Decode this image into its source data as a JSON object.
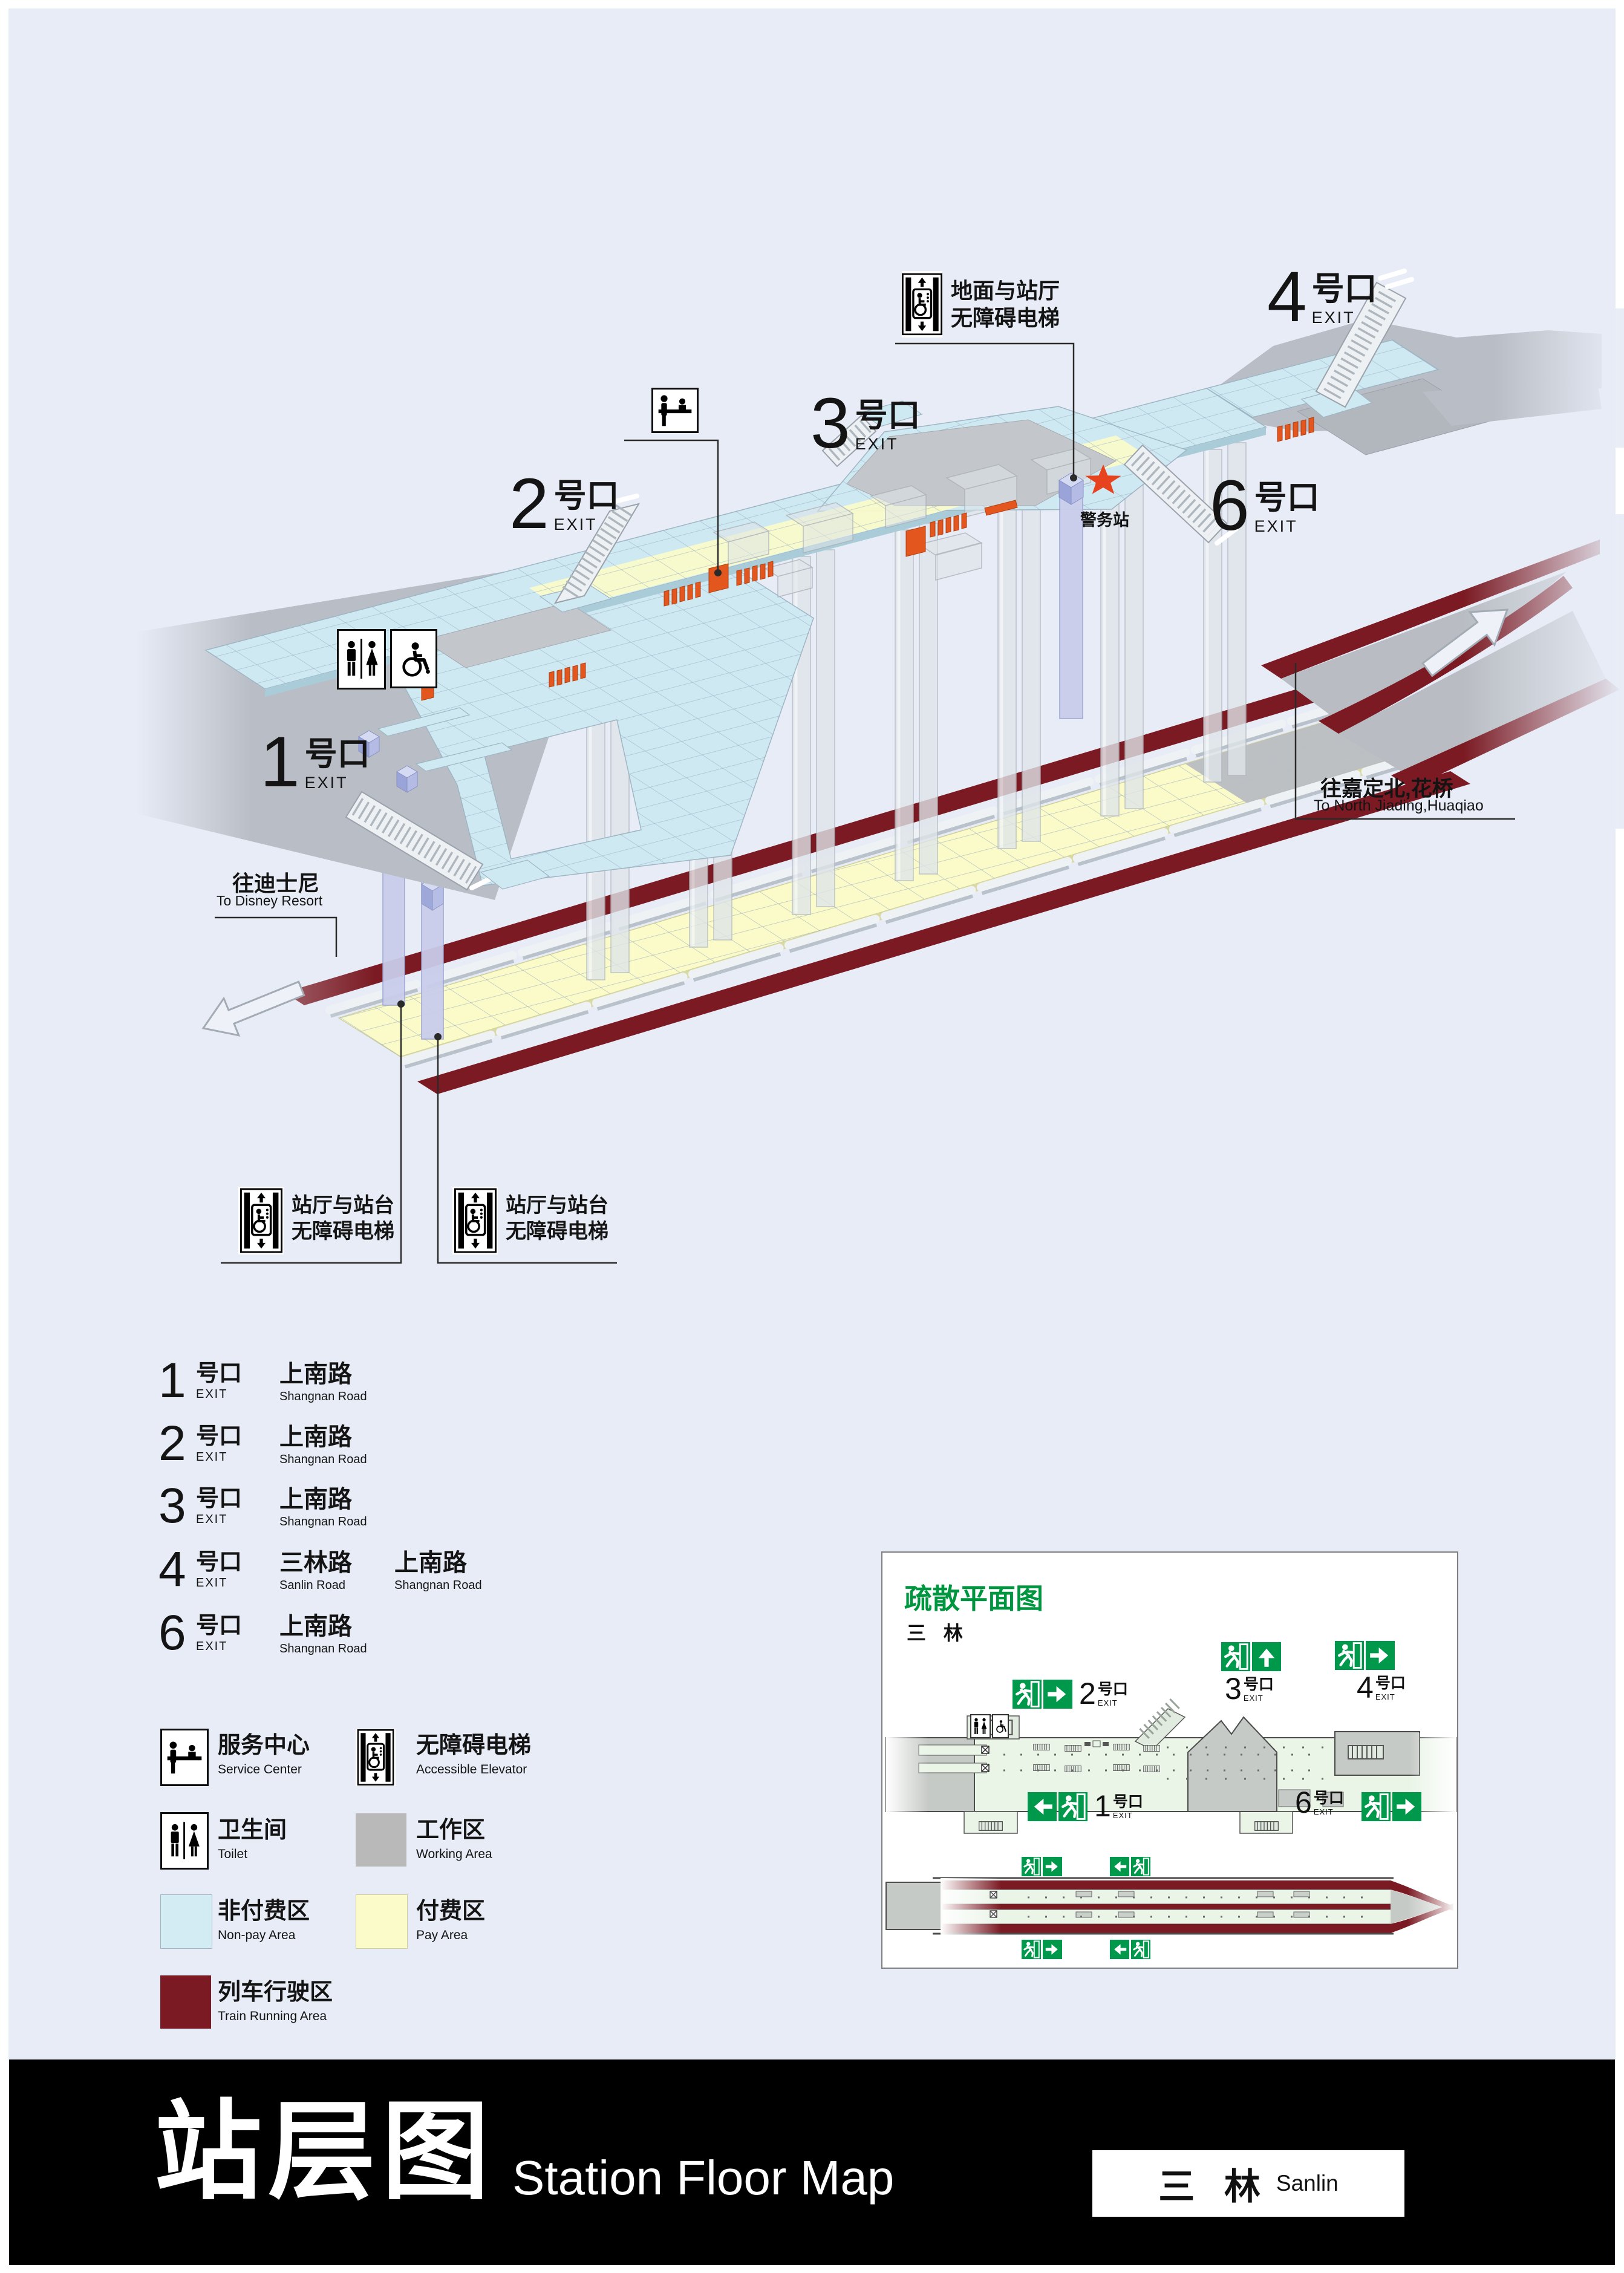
{
  "colors": {
    "background": "#e7ecf6",
    "non_pay_area": "#d3ecf4",
    "pay_area": "#fbfbc9",
    "working_area": "#b9b9b9",
    "train_running_area": "#7b1a23",
    "exit_sign_green": "#00984a",
    "inset_title_green": "#009640",
    "gate_orange": "#e3561d",
    "police_star_red": "#e8431f"
  },
  "iso": {
    "exit1": {
      "num": "1",
      "suffix": "号口",
      "exit": "EXIT"
    },
    "exit2": {
      "num": "2",
      "suffix": "号口",
      "exit": "EXIT"
    },
    "exit3": {
      "num": "3",
      "suffix": "号口",
      "exit": "EXIT"
    },
    "exit4": {
      "num": "4",
      "suffix": "号口",
      "exit": "EXIT"
    },
    "exit6": {
      "num": "6",
      "suffix": "号口",
      "exit": "EXIT"
    },
    "police_station": "警务站",
    "ground_elevator_line1": "地面与站厅",
    "ground_elevator_line2": "无障碍电梯",
    "platform_elevator_line1": "站厅与站台",
    "platform_elevator_line2": "无障碍电梯",
    "to_disney_zh": "往迪士尼",
    "to_disney_en": "To Disney Resort",
    "to_jiading_zh": "往嘉定北,花桥",
    "to_jiading_en": "To North Jiading,Huaqiao"
  },
  "exit_list": {
    "rows": [
      {
        "num": "1",
        "suffix": "号口",
        "exit": "EXIT",
        "road1_zh": "上南路",
        "road1_en": "Shangnan Road"
      },
      {
        "num": "2",
        "suffix": "号口",
        "exit": "EXIT",
        "road1_zh": "上南路",
        "road1_en": "Shangnan Road"
      },
      {
        "num": "3",
        "suffix": "号口",
        "exit": "EXIT",
        "road1_zh": "上南路",
        "road1_en": "Shangnan Road"
      },
      {
        "num": "4",
        "suffix": "号口",
        "exit": "EXIT",
        "road1_zh": "三林路",
        "road1_en": "Sanlin Road",
        "road2_zh": "上南路",
        "road2_en": "Shangnan Road"
      },
      {
        "num": "6",
        "suffix": "号口",
        "exit": "EXIT",
        "road1_zh": "上南路",
        "road1_en": "Shangnan Road"
      }
    ]
  },
  "legend": {
    "service_center_zh": "服务中心",
    "service_center_en": "Service Center",
    "accessible_elevator_zh": "无障碍电梯",
    "accessible_elevator_en": "Accessible Elevator",
    "toilet_zh": "卫生间",
    "toilet_en": "Toilet",
    "working_area_zh": "工作区",
    "working_area_en": "Working Area",
    "non_pay_zh": "非付费区",
    "non_pay_en": "Non-pay Area",
    "pay_zh": "付费区",
    "pay_en": "Pay Area",
    "train_zh": "列车行驶区",
    "train_en": "Train Running Area"
  },
  "inset": {
    "title": "疏散平面图",
    "subtitle": "三 林",
    "exit1": {
      "num": "1",
      "suffix": "号口",
      "exit": "EXIT"
    },
    "exit2": {
      "num": "2",
      "suffix": "号口",
      "exit": "EXIT"
    },
    "exit3": {
      "num": "3",
      "suffix": "号口",
      "exit": "EXIT"
    },
    "exit4": {
      "num": "4",
      "suffix": "号口",
      "exit": "EXIT"
    },
    "exit6": {
      "num": "6",
      "suffix": "号口",
      "exit": "EXIT"
    }
  },
  "footer": {
    "title_zh": "站层图",
    "title_en": "Station Floor Map",
    "station_zh": "三 林",
    "station_en": "Sanlin"
  }
}
